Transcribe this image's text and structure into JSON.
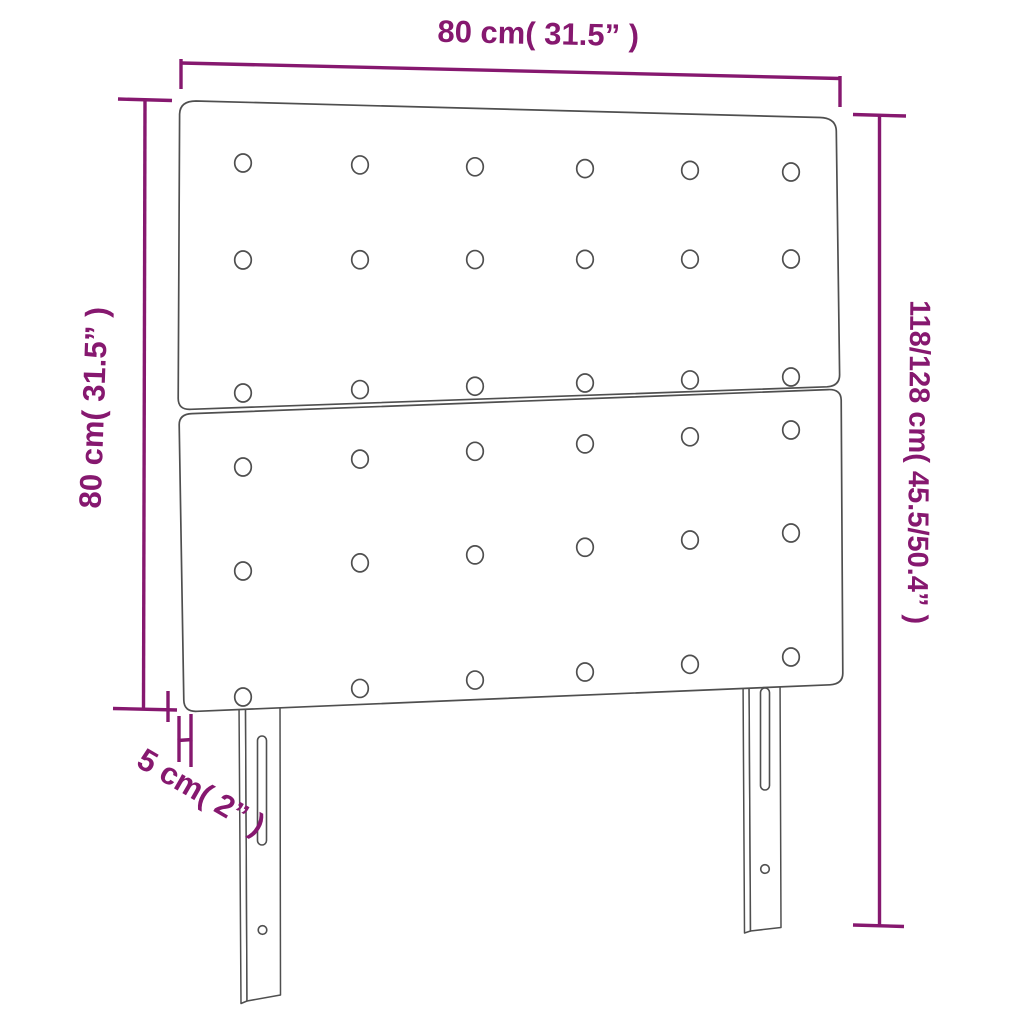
{
  "image": {
    "subject": "Two-panel tufted headboard with two height-adjustable legs, technical dimension diagram",
    "background": "#FFFFFF"
  },
  "colors": {
    "dimension_lines": "#86186F",
    "product_outline": "#4F4F4F"
  },
  "dimensions": {
    "width": {
      "label": "80 cm( 31.5” )"
    },
    "panel_height": {
      "label": "80 cm( 31.5” )"
    },
    "total_height": {
      "label": "118/128 cm( 45.5/50.4” )"
    },
    "thickness": {
      "label": "5 cm( 2” )"
    }
  },
  "headboard": {
    "panels": 2,
    "button_grid": {
      "rows_per_panel": 3,
      "cols": 6
    },
    "legs": 2,
    "leg_features": [
      "height-adjustment-slot",
      "screw-hole"
    ]
  }
}
